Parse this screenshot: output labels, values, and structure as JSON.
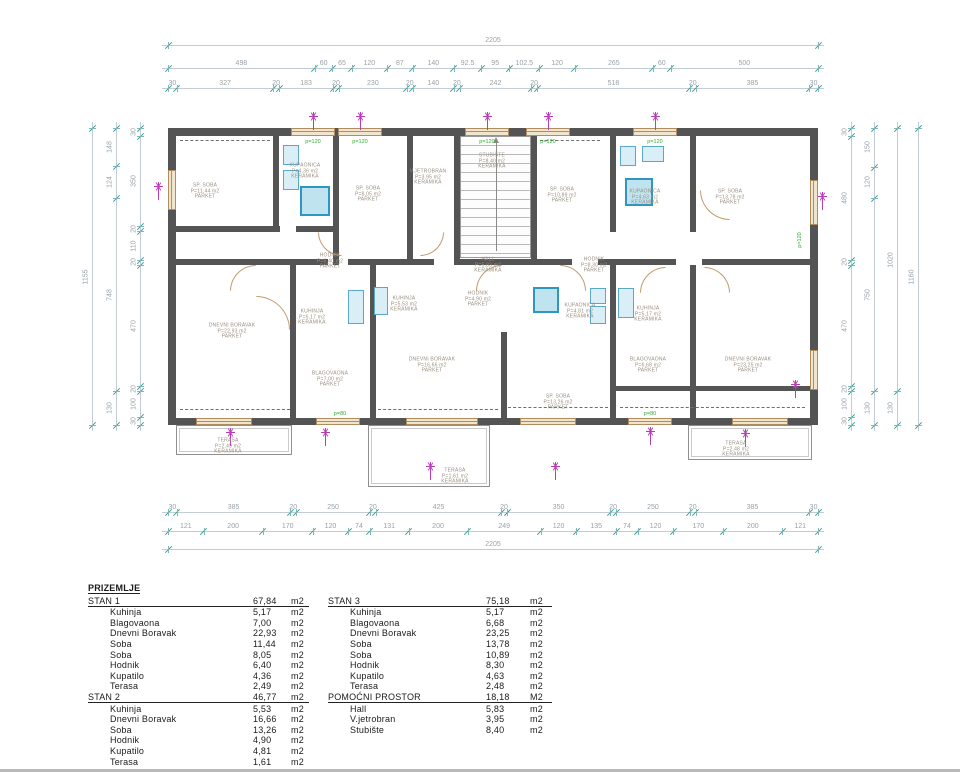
{
  "drawing": {
    "floor_title": "PRIZEMLJE",
    "colors": {
      "wall": "#545454",
      "tick": "#2e9e96",
      "vent": "#b83db8",
      "fixture": "#58a8c6",
      "room_text": "#9a8f80",
      "dim_text": "#98a2aa",
      "window_label": "#2eae2e"
    }
  },
  "dim_chains": {
    "top": [
      [
        "2205"
      ],
      [
        "498",
        "60",
        "65",
        "120",
        "87",
        "140",
        "92.5",
        "95",
        "102.5",
        "120",
        "265",
        "60",
        "500"
      ],
      [
        "30",
        "327",
        "20",
        "183",
        "20",
        "230",
        "20",
        "140",
        "20",
        "242",
        "20",
        "518",
        "20",
        "385",
        "30"
      ]
    ],
    "bottom": [
      [
        "30",
        "385",
        "20",
        "250",
        "20",
        "425",
        "20",
        "350",
        "20",
        "250",
        "20",
        "385",
        "30"
      ],
      [
        "121",
        "200",
        "170",
        "120",
        "74",
        "131",
        "200",
        "249",
        "120",
        "135",
        "74",
        "120",
        "170",
        "200",
        "121"
      ],
      [
        "2205"
      ]
    ],
    "left": [
      [
        "30",
        "350",
        "20",
        "110",
        "20",
        "470",
        "20",
        "100",
        "30"
      ],
      [
        "148",
        "124",
        "748",
        "130"
      ],
      [
        "1155"
      ]
    ],
    "right": [
      [
        "30",
        "480",
        "20",
        "470",
        "20",
        "100",
        "30"
      ],
      [
        "150",
        "120",
        "750",
        "130"
      ],
      [
        "1020",
        "130"
      ],
      [
        "1160"
      ]
    ]
  },
  "rooms": [
    {
      "name": "SP. SOBA",
      "area": "11,44",
      "floor": "PARKET"
    },
    {
      "name": "KUPAONICA",
      "area": "4,36",
      "floor": "KERAMIKA"
    },
    {
      "name": "SP. SOBA",
      "area": "8,05",
      "floor": "PARKET"
    },
    {
      "name": "V.JETROBRAN",
      "area": "3,95",
      "floor": "KERAMIKA"
    },
    {
      "name": "STUBIŠTE",
      "area": "8,40",
      "floor": "KERAMIKA"
    },
    {
      "name": "SP. SOBA",
      "area": "10,89",
      "floor": "PARKET"
    },
    {
      "name": "KUPAONICA",
      "area": "4,63",
      "floor": "KERAMIKA"
    },
    {
      "name": "SP. SOBA",
      "area": "13,78",
      "floor": "PARKET"
    },
    {
      "name": "HODNIK",
      "area": "6,40",
      "floor": "PARKET"
    },
    {
      "name": "HALL",
      "area": "5,83",
      "floor": "KERAMIKA"
    },
    {
      "name": "HODNIK",
      "area": "8,30",
      "floor": "PARKET"
    },
    {
      "name": "KUHINJA",
      "area": "5,17",
      "floor": "KERAMIKA"
    },
    {
      "name": "BLAGOVAONA",
      "area": "7,00",
      "floor": "PARKET"
    },
    {
      "name": "DNEVNI BORAVAK",
      "area": "22,93",
      "floor": "PARKET"
    },
    {
      "name": "KUHINJA",
      "area": "5,53",
      "floor": "KERAMIKA"
    },
    {
      "name": "DNEVNI BORAVAK",
      "area": "16,66",
      "floor": "PARKET"
    },
    {
      "name": "KUPAONICA",
      "area": "4,81",
      "floor": "KERAMIKA"
    },
    {
      "name": "SP. SOBA",
      "area": "13,26",
      "floor": "PARKET"
    },
    {
      "name": "HODNIK",
      "area": "4,90",
      "floor": "PARKET"
    },
    {
      "name": "KUHINJA",
      "area": "5,17",
      "floor": "KERAMIKA"
    },
    {
      "name": "BLAGOVAONA",
      "area": "6,68",
      "floor": "PARKET"
    },
    {
      "name": "DNEVNI BORAVAK",
      "area": "23,25",
      "floor": "PARKET"
    },
    {
      "name": "TERASA",
      "area": "2,49",
      "floor": "KERAMIKA"
    },
    {
      "name": "TERASA",
      "area": "1,61",
      "floor": "KERAMIKA"
    },
    {
      "name": "TERASA",
      "area": "2,48",
      "floor": "KERAMIKA"
    }
  ],
  "window_labels": [
    {
      "text": "p=120"
    },
    {
      "text": "p=120"
    },
    {
      "text": "p=120"
    },
    {
      "text": "p=120"
    },
    {
      "text": "p=120"
    },
    {
      "text": "p=80"
    },
    {
      "text": "p=80"
    },
    {
      "text": "p=120"
    }
  ],
  "tables": {
    "title": "PRIZEMLJE",
    "unit": "m2",
    "columns": [
      {
        "groups": [
          {
            "name": "STAN 1",
            "area": "67,84",
            "unit": "m2",
            "rows": [
              [
                "Kuhinja",
                "5,17",
                "m2"
              ],
              [
                "Blagovaona",
                "7,00",
                "m2"
              ],
              [
                "Dnevni Boravak",
                "22,93",
                "m2"
              ],
              [
                "Soba",
                "11,44",
                "m2"
              ],
              [
                "Soba",
                "8,05",
                "m2"
              ],
              [
                "Hodnik",
                "6,40",
                "m2"
              ],
              [
                "Kupatilo",
                "4,36",
                "m2"
              ],
              [
                "Terasa",
                "2,49",
                "m2"
              ]
            ]
          },
          {
            "name": "STAN 2",
            "area": "46,77",
            "unit": "m2",
            "rows": [
              [
                "Kuhinja",
                "5,53",
                "m2"
              ],
              [
                "Dnevni Boravak",
                "16,66",
                "m2"
              ],
              [
                "Soba",
                "13,26",
                "m2"
              ],
              [
                "Hodnik",
                "4,90",
                "m2"
              ],
              [
                "Kupatilo",
                "4,81",
                "m2"
              ],
              [
                "Terasa",
                "1,61",
                "m2"
              ]
            ]
          }
        ]
      },
      {
        "groups": [
          {
            "name": "STAN 3",
            "area": "75,18",
            "unit": "m2",
            "rows": [
              [
                "Kuhinja",
                "5,17",
                "m2"
              ],
              [
                "Blagovaona",
                "6,68",
                "m2"
              ],
              [
                "Dnevni Boravak",
                "23,25",
                "m2"
              ],
              [
                "Soba",
                "13,78",
                "m2"
              ],
              [
                "Soba",
                "10,89",
                "m2"
              ],
              [
                "Hodnik",
                "8,30",
                "m2"
              ],
              [
                "Kupatilo",
                "4,63",
                "m2"
              ],
              [
                "Terasa",
                "2,48",
                "m2"
              ]
            ]
          },
          {
            "name": "POMOĆNI PROSTOR",
            "area": "18,18",
            "unit": "M2",
            "rows": [
              [
                "Hall",
                "5,83",
                "m2"
              ],
              [
                "V.jetrobran",
                "3,95",
                "m2"
              ],
              [
                "Stubište",
                "8,40",
                "m2"
              ]
            ]
          }
        ]
      }
    ]
  }
}
